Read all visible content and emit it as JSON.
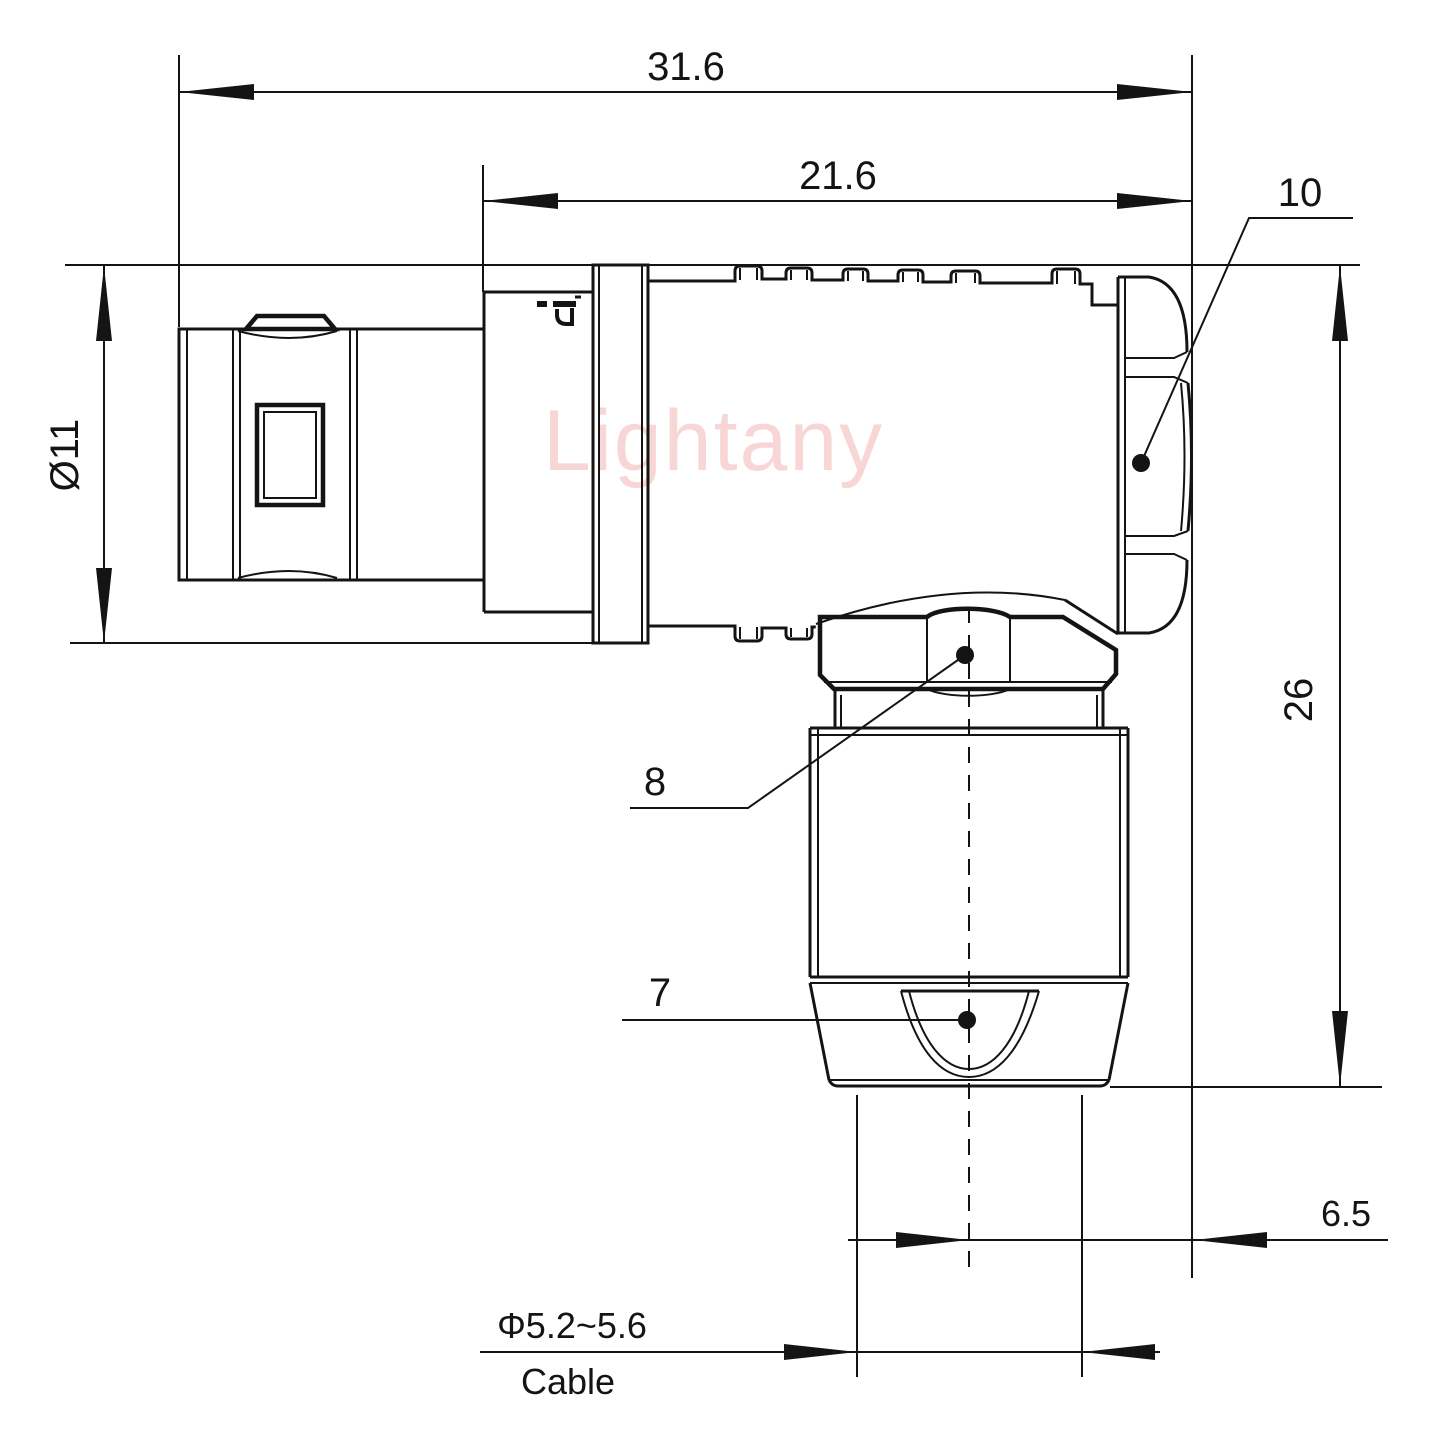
{
  "watermark": {
    "text": "Lightany",
    "color": "#f5bcbc"
  },
  "drawing": {
    "background": "#ffffff",
    "line_color": "#141414",
    "dimensions": {
      "overall_length": "31.6",
      "body_length": "21.6",
      "rear_nut_ref": "10",
      "shell_diameter": "Ø11",
      "overall_height": "26",
      "coupling_nut_ref": "8",
      "clamp_sleeve_ref": "7",
      "axis_to_rear": "6.5",
      "cable_diameter": "Φ5.2~5.6",
      "cable_label": "Cable"
    }
  }
}
